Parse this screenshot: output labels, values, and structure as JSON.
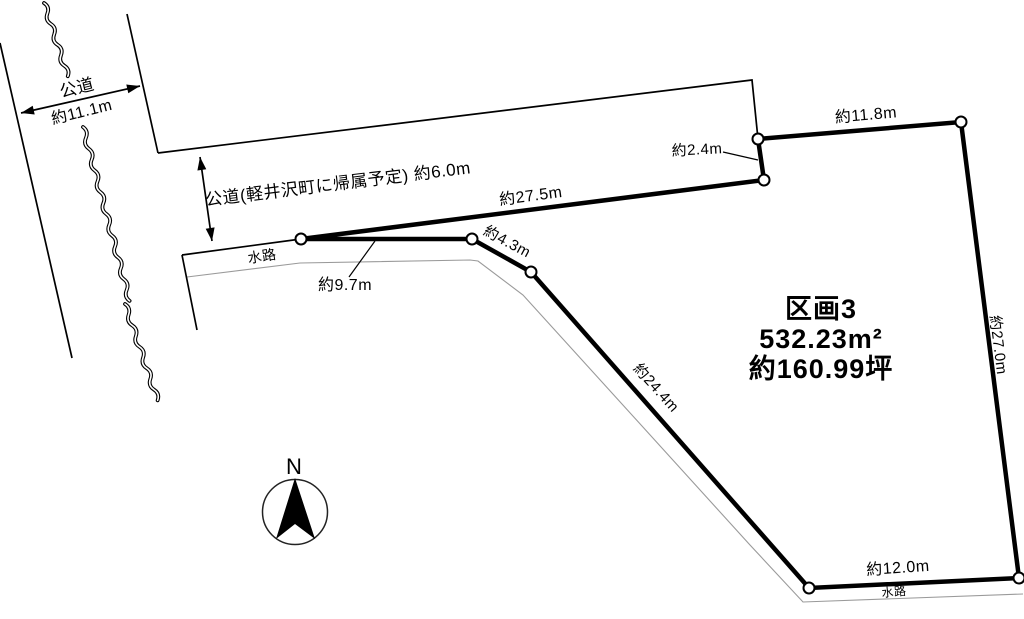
{
  "colors": {
    "line": "#000000",
    "waterway_line": "#9a9a9a",
    "background": "#ffffff"
  },
  "compass": {
    "north_label": "N"
  },
  "roads": {
    "left": {
      "name": "公道",
      "width": "約11.1m"
    },
    "top": {
      "label": "公道(軽井沢町に帰属予定) 約6.0m"
    }
  },
  "waterways": {
    "left_label": "水路",
    "bottom_label": "水路"
  },
  "plot": {
    "name": "区画3",
    "area_m2": "532.23m²",
    "area_tsubo": "約160.99坪"
  },
  "measurements": {
    "m9_7": "約9.7m",
    "m27_5": "約27.5m",
    "m2_4": "約2.4m",
    "m11_8": "約11.8m",
    "m27_0": "約27.0m",
    "m24_4": "約24.4m",
    "m4_3": "約4.3m",
    "m12_0": "約12.0m"
  }
}
